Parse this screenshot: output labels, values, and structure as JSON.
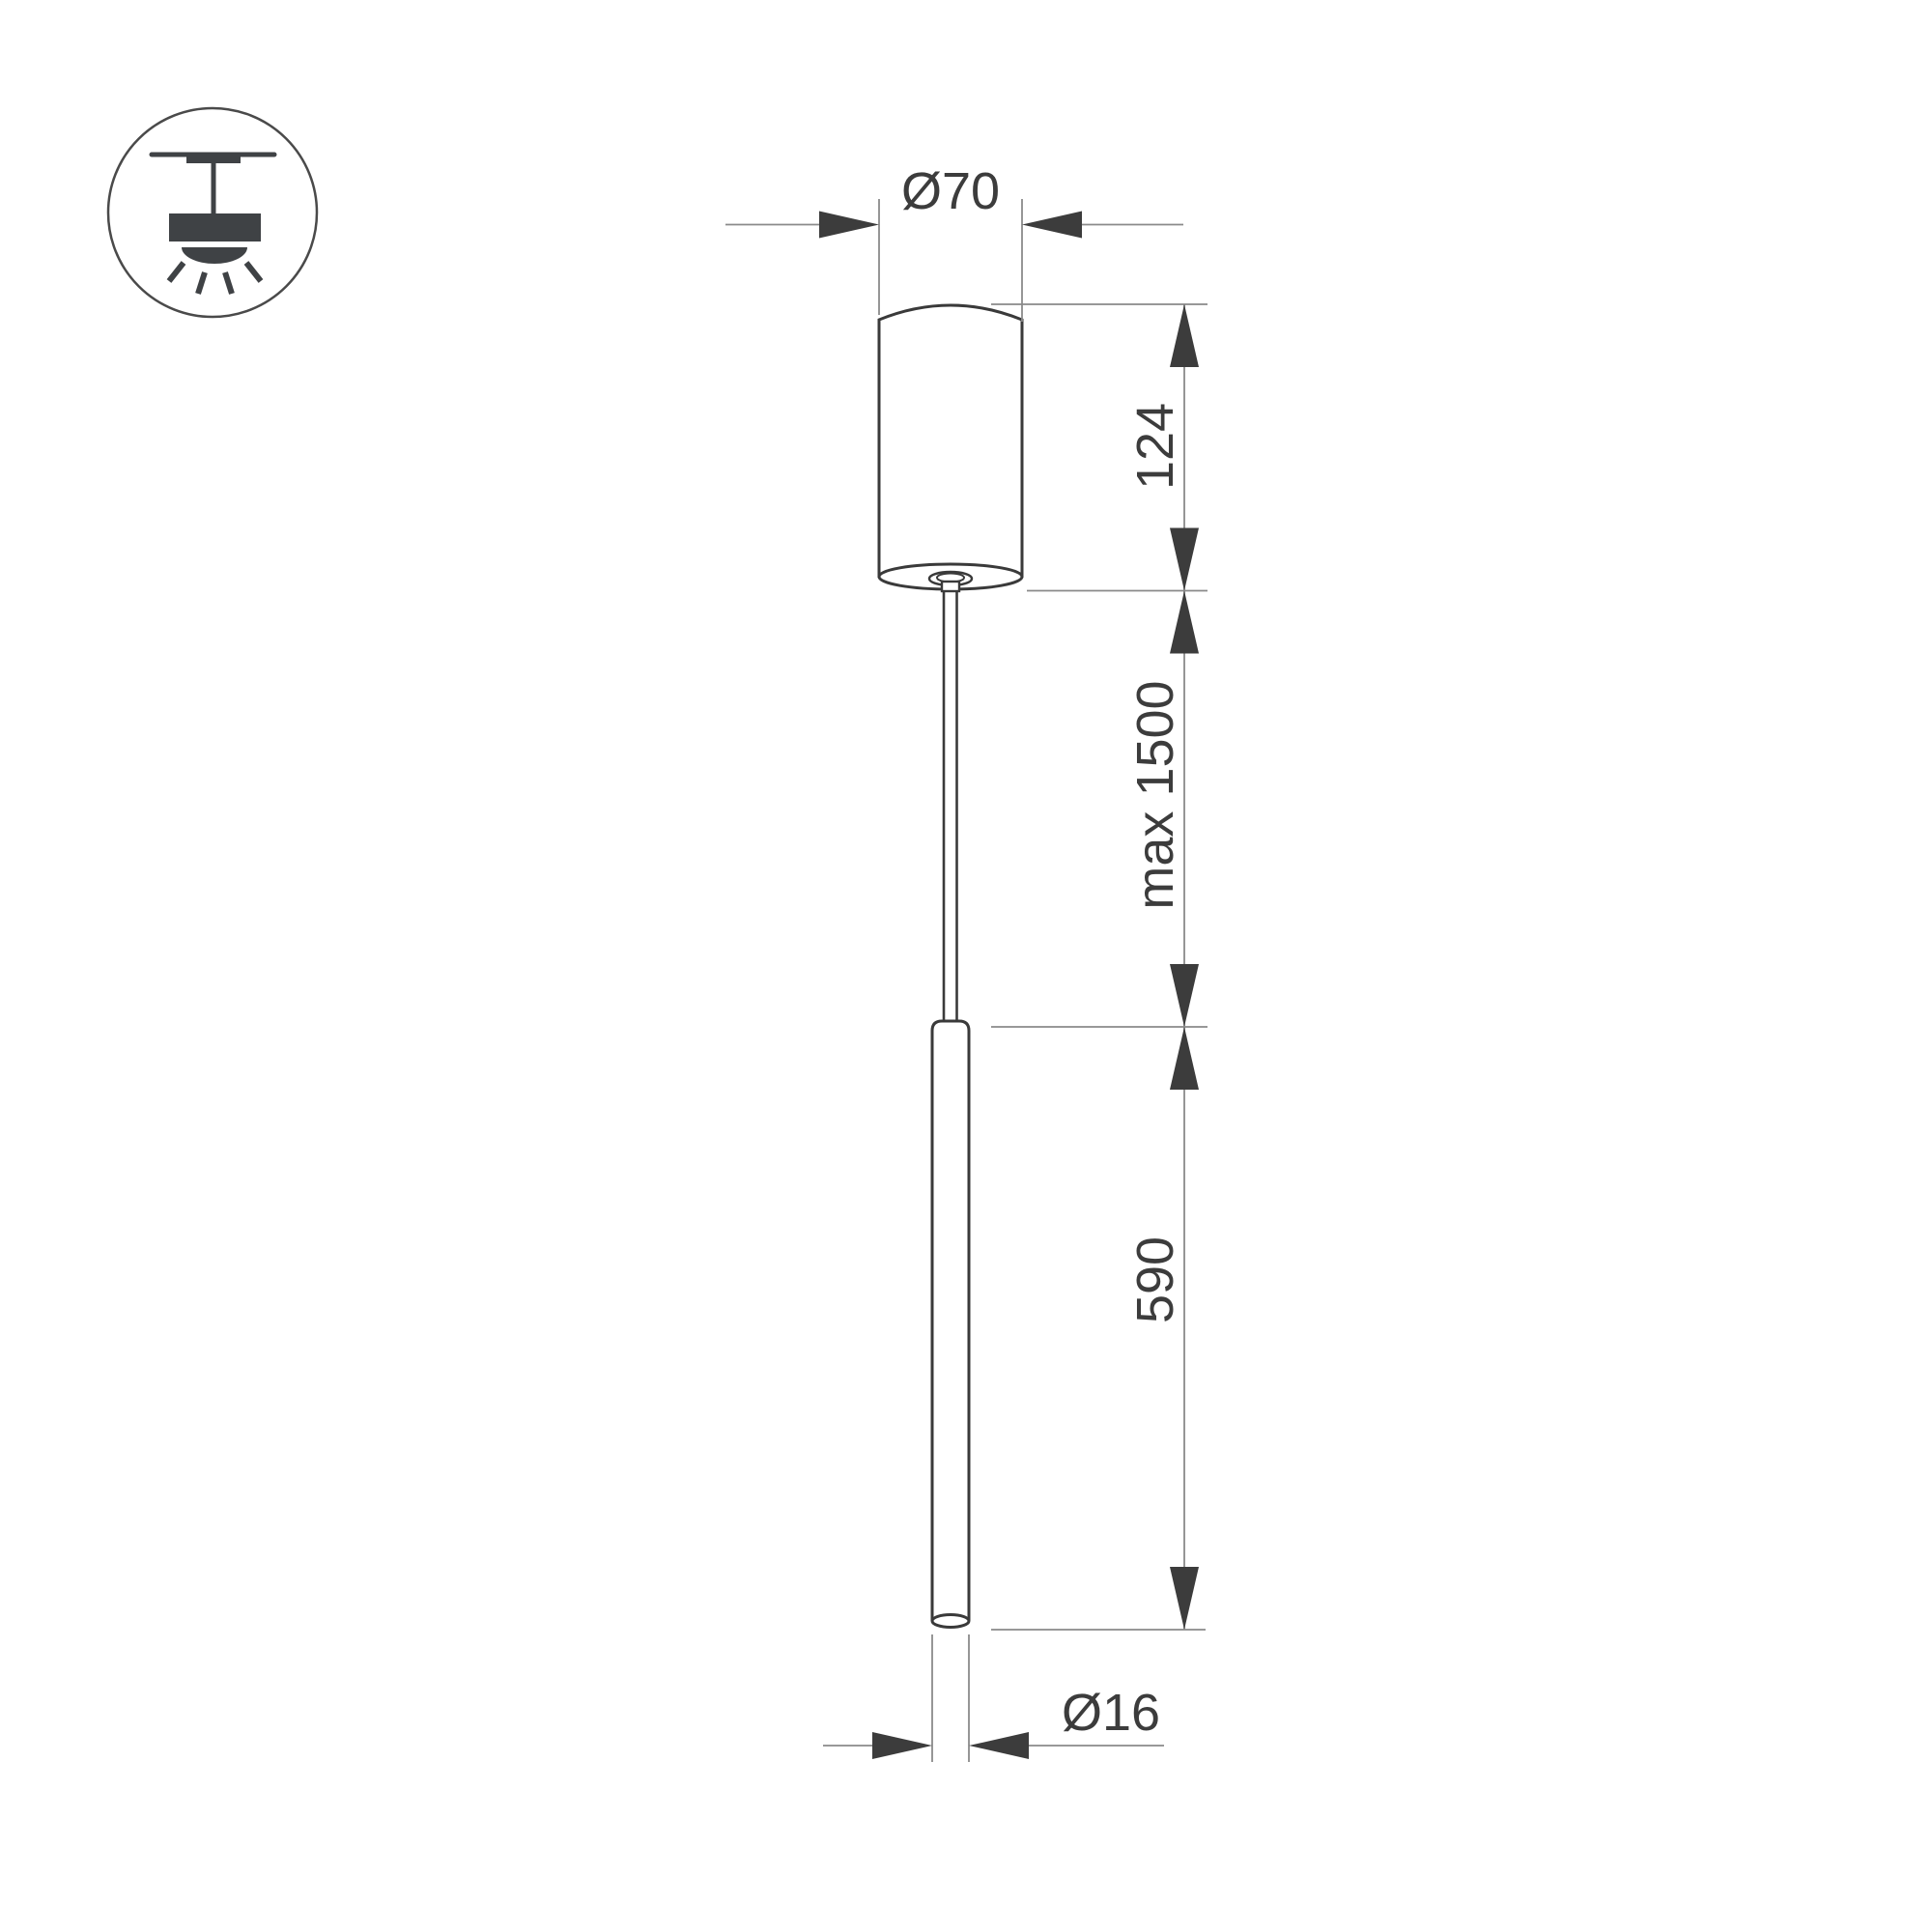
{
  "drawing": {
    "type": "pendant-luminaire-dimension-drawing",
    "icon": "ceiling-mounted-pendant-light-icon",
    "dimensions": {
      "canopy_diameter": "Ø70",
      "canopy_height": "124",
      "suspension_length": "max 1500",
      "tube_length": "590",
      "tube_diameter": "Ø16"
    },
    "colors": {
      "background": "#ffffff",
      "object_outline": "#3a3a3a",
      "dimension_line": "#8a8a8a",
      "arrow_and_text": "#3c3c3c",
      "icon": "#3f4245"
    }
  }
}
